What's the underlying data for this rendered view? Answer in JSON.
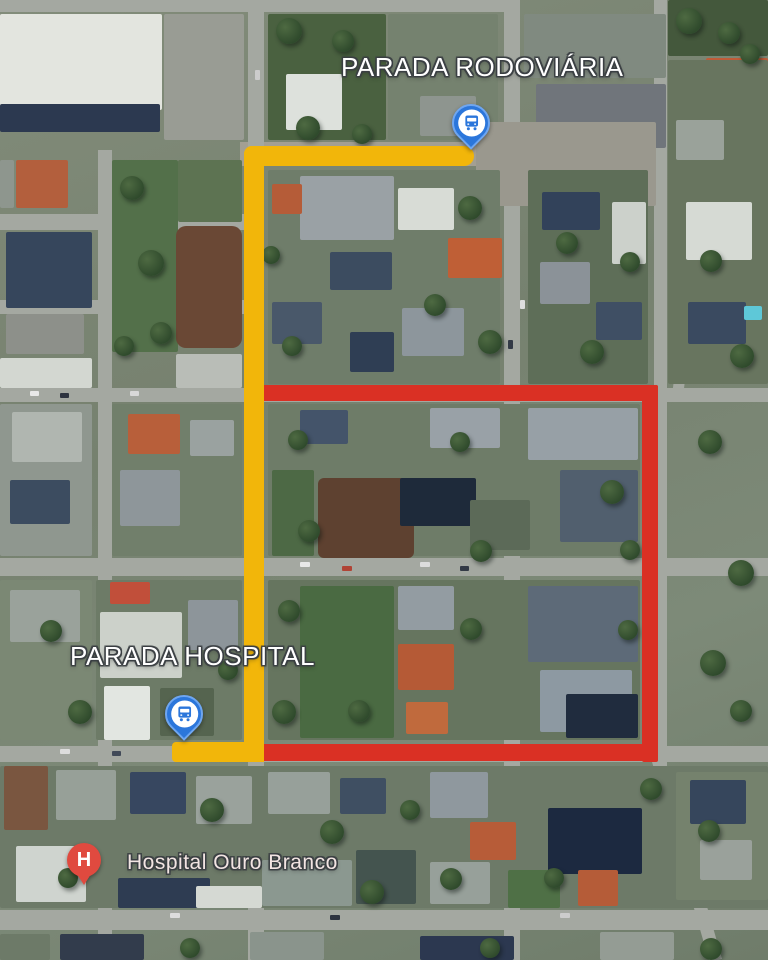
{
  "map": {
    "labels": {
      "rodoviaria": "PARADA RODOVIÁRIA",
      "hospital_stop": "PARADA HOSPITAL",
      "hospital": "Hospital Ouro Branco"
    },
    "pins": {
      "rodoviaria_bus": {
        "icon": "bus-icon"
      },
      "hospital_bus": {
        "icon": "bus-icon"
      },
      "hospital_marker": {
        "icon": "hospital-h-pin",
        "letter": "H"
      }
    },
    "colors": {
      "route-yellow": "#F2B60A",
      "route-red": "#DA3024",
      "bus-pin-blue": "#2B76DB",
      "bus-pin-border": "#6FA6F0",
      "hospital-pin-red": "#E04A3F",
      "label-text": "#FFFFFF",
      "hospital-label-text": "#F2E4E2"
    }
  }
}
